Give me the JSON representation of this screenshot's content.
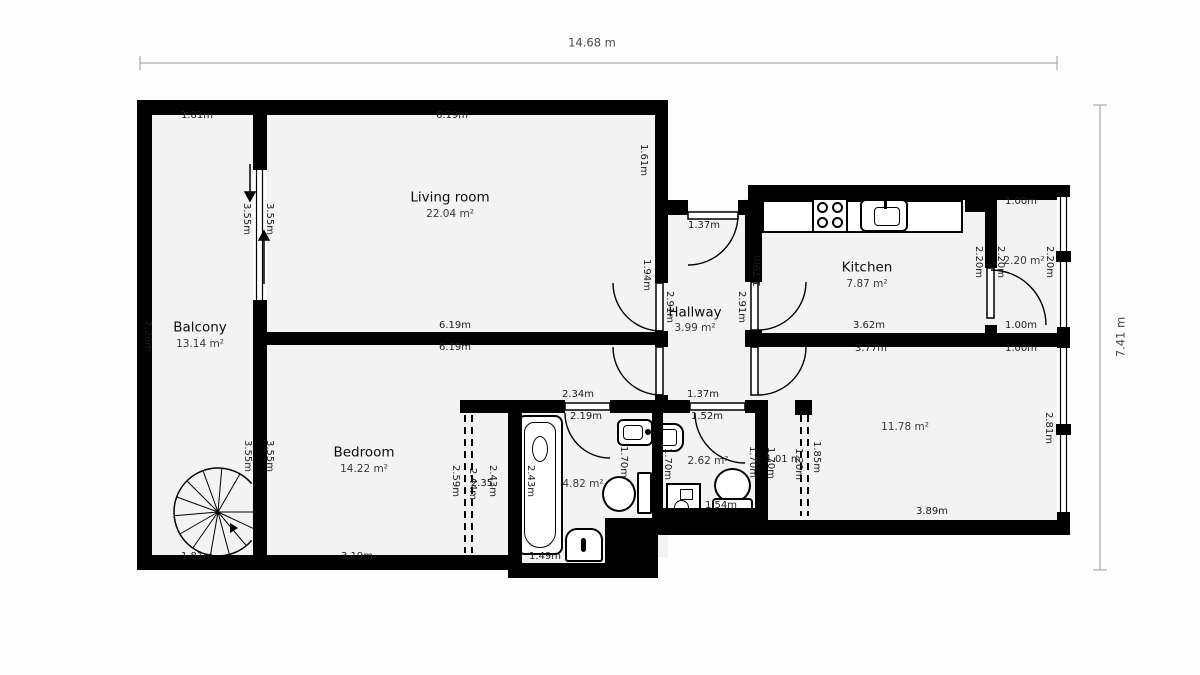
{
  "overall": {
    "width": "14.68 m",
    "height": "7.41 m"
  },
  "colors": {
    "wall": "#000000",
    "floor": "#f3f3f3",
    "page": "#fdfdfd",
    "dim_text": "#1b1b1b"
  },
  "rooms": [
    {
      "id": "balcony",
      "name": "Balcony",
      "area": "13.14 m²",
      "nx": 200,
      "ny": 328,
      "ax": 200,
      "ay": 344
    },
    {
      "id": "living-room",
      "name": "Living room",
      "area": "22.04 m²",
      "nx": 450,
      "ny": 198,
      "ax": 450,
      "ay": 214
    },
    {
      "id": "hallway",
      "name": "Hallway",
      "area": "3.99 m²",
      "nx": 695,
      "ny": 313,
      "ax": 695,
      "ay": 328
    },
    {
      "id": "kitchen",
      "name": "Kitchen",
      "area": "7.87 m²",
      "nx": 867,
      "ny": 268,
      "ax": 867,
      "ay": 284
    },
    {
      "id": "bedroom",
      "name": "Bedroom",
      "area": "14.22 m²",
      "nx": 364,
      "ny": 453,
      "ax": 364,
      "ay": 469
    },
    {
      "id": "storage",
      "name": "",
      "area": "2.20 m²",
      "nx": 0,
      "ny": 0,
      "ax": 1024,
      "ay": 261
    },
    {
      "id": "bathroom",
      "name": "",
      "area": "4.82 m²",
      "nx": 0,
      "ny": 0,
      "ax": 583,
      "ay": 484
    },
    {
      "id": "wc",
      "name": "",
      "area": "2.62 m²",
      "nx": 0,
      "ny": 0,
      "ax": 708,
      "ay": 461
    },
    {
      "id": "room",
      "name": "",
      "area": "11.78 m²",
      "nx": 0,
      "ny": 0,
      "ax": 905,
      "ay": 427
    }
  ],
  "dim_labels": [
    {
      "t": "1.81m",
      "x": 197,
      "y": 116,
      "r": 0
    },
    {
      "t": "6.19m",
      "x": 452,
      "y": 116,
      "r": 0
    },
    {
      "t": "1.61m",
      "x": 643,
      "y": 160,
      "r": 90
    },
    {
      "t": "3.55m",
      "x": 246,
      "y": 219,
      "r": 90
    },
    {
      "t": "3.55m",
      "x": 269,
      "y": 219,
      "r": 90
    },
    {
      "t": "7.26m",
      "x": 147,
      "y": 336,
      "r": 90
    },
    {
      "t": "3.55m",
      "x": 247,
      "y": 456,
      "r": 90
    },
    {
      "t": "3.55m",
      "x": 269,
      "y": 456,
      "r": 90
    },
    {
      "t": "1.81m",
      "x": 197,
      "y": 557,
      "r": 0
    },
    {
      "t": "6.19m",
      "x": 455,
      "y": 326,
      "r": 0
    },
    {
      "t": "6.19m",
      "x": 455,
      "y": 348,
      "r": 0
    },
    {
      "t": "3.19m",
      "x": 357,
      "y": 557,
      "r": 0
    },
    {
      "t": "1.37m",
      "x": 704,
      "y": 226,
      "r": 0
    },
    {
      "t": "1.94m",
      "x": 646,
      "y": 275,
      "r": 90
    },
    {
      "t": "2.91m",
      "x": 669,
      "y": 307,
      "r": 90
    },
    {
      "t": "2.91m",
      "x": 741,
      "y": 307,
      "r": 90
    },
    {
      "t": "1.79m",
      "x": 758,
      "y": 271,
      "r": -90
    },
    {
      "t": "1.37m",
      "x": 703,
      "y": 395,
      "r": 0
    },
    {
      "t": "1.52m",
      "x": 707,
      "y": 417,
      "r": 0
    },
    {
      "t": "3.62m",
      "x": 869,
      "y": 326,
      "r": 0
    },
    {
      "t": "3.77m",
      "x": 871,
      "y": 349,
      "r": 0
    },
    {
      "t": "1.00m",
      "x": 1021,
      "y": 202,
      "r": 0
    },
    {
      "t": "2.20m",
      "x": 978,
      "y": 262,
      "r": 90
    },
    {
      "t": "2.20m",
      "x": 1000,
      "y": 262,
      "r": 90
    },
    {
      "t": "2.20m",
      "x": 1049,
      "y": 262,
      "r": 90
    },
    {
      "t": "1.00m",
      "x": 1021,
      "y": 326,
      "r": 0
    },
    {
      "t": "1.00m",
      "x": 1021,
      "y": 349,
      "r": 0
    },
    {
      "t": "2.81m",
      "x": 1048,
      "y": 428,
      "r": 90
    },
    {
      "t": "3.89m",
      "x": 932,
      "y": 512,
      "r": 0
    },
    {
      "t": "1.85m",
      "x": 816,
      "y": 457,
      "r": 90
    },
    {
      "t": "1.20m",
      "x": 798,
      "y": 464,
      "r": 90
    },
    {
      "t": "1.01 m",
      "x": 783,
      "y": 460,
      "r": 0
    },
    {
      "t": "1.70m",
      "x": 752,
      "y": 462,
      "r": 90
    },
    {
      "t": "1.70m",
      "x": 770,
      "y": 463,
      "r": 90
    },
    {
      "t": "1.70m",
      "x": 667,
      "y": 464,
      "r": 90
    },
    {
      "t": "1.70m",
      "x": 623,
      "y": 462,
      "r": 90
    },
    {
      "t": "1.54m",
      "x": 721,
      "y": 506,
      "r": 0
    },
    {
      "t": "2.34m",
      "x": 578,
      "y": 395,
      "r": 0
    },
    {
      "t": "2.19m",
      "x": 586,
      "y": 417,
      "r": 0
    },
    {
      "t": "1.49m",
      "x": 545,
      "y": 557,
      "r": 0
    },
    {
      "t": "2.43m",
      "x": 530,
      "y": 481,
      "r": 90
    },
    {
      "t": "2.43m",
      "x": 492,
      "y": 481,
      "r": 90
    },
    {
      "t": "2.35",
      "x": 482,
      "y": 484,
      "r": 0
    },
    {
      "t": "2.44m",
      "x": 472,
      "y": 484,
      "r": 90
    },
    {
      "t": "2.59m",
      "x": 455,
      "y": 481,
      "r": 90
    }
  ]
}
